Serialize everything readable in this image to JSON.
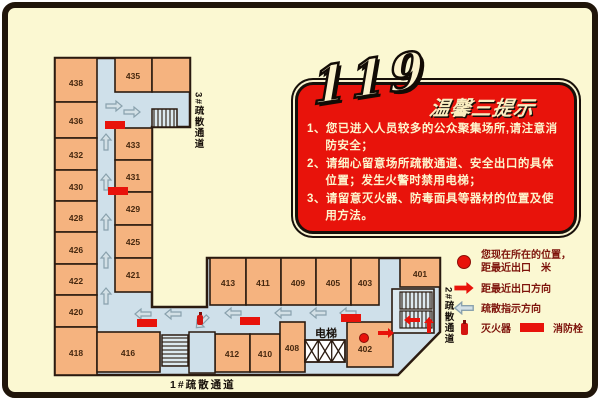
{
  "banner": {
    "number": "119",
    "title": "温馨三提示",
    "tips": [
      "1、您已进入人员较多的公众聚集场所,请注意消防安全；",
      "2、请细心留意场所疏散通道、安全出口的具体位置；发生火警时禁用电梯；",
      "3、请留意灭火器、防毒面具等器材的位置及使用方法。"
    ]
  },
  "plan": {
    "elevator_label": "电梯",
    "stair_labels": {
      "s3": "3#疏散通道",
      "s2": "2#疏散通道",
      "s1": "1#疏散通道"
    },
    "rooms": {
      "438": "438",
      "436": "436",
      "432": "432",
      "430": "430",
      "428": "428",
      "426": "426",
      "422": "422",
      "420": "420",
      "418": "418",
      "435": "435",
      "433": "433",
      "431": "431",
      "429": "429",
      "425": "425",
      "421": "421",
      "416": "416",
      "413": "413",
      "412": "412",
      "411": "411",
      "410": "410",
      "409": "409",
      "408": "408",
      "405": "405",
      "403": "403",
      "402": "402",
      "401": "401"
    }
  },
  "legend": {
    "location_line1": "您现在所在的位置，",
    "location_line2": "距最近出口　米",
    "exit_direction": "距最近出口方向",
    "evac_direction": "疏散指示方向",
    "extinguisher": "灭火器",
    "hydrant": "消防栓"
  },
  "colors": {
    "accent_red": "#E8130B",
    "room_fill": "#F5B37F",
    "corridor": "#CFE0EA",
    "background": "#FBF8D2",
    "wall": "#2B1B10",
    "legend_text": "#7D120A",
    "banner_text": "#FDF5CD"
  }
}
